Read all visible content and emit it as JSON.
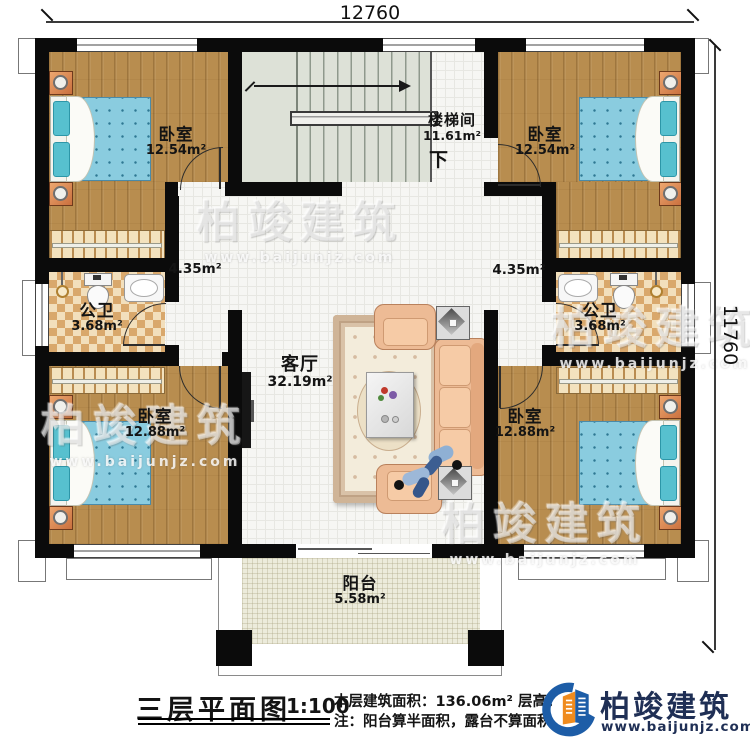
{
  "dimensions": {
    "width_top": "12760",
    "height_right": "11760"
  },
  "watermark": {
    "brand": "柏竣建筑",
    "url": "www.baijunjz.com"
  },
  "rooms": {
    "bedroom_tl": {
      "name": "卧室",
      "area": "12.54m²"
    },
    "bedroom_tr": {
      "name": "卧室",
      "area": "12.54m²"
    },
    "bedroom_bl": {
      "name": "卧室",
      "area": "12.88m²"
    },
    "bedroom_br": {
      "name": "卧室",
      "area": "12.88m²"
    },
    "stairwell": {
      "name": "楼梯间",
      "area": "11.61m²",
      "down": "下"
    },
    "bathroom_left": {
      "name": "公卫",
      "area": "3.68m²"
    },
    "bathroom_right": {
      "name": "公卫",
      "area": "3.68m²"
    },
    "hallway_left": {
      "area": "4.35m²"
    },
    "hallway_right": {
      "area": "4.35m²"
    },
    "living_room": {
      "name": "客厅",
      "area": "32.19m²"
    },
    "balcony": {
      "name": "阳台",
      "area": "5.58m²"
    }
  },
  "footer": {
    "title": "三层平面图",
    "scale": "1:100",
    "info_line1": "本层建筑面积：136.06m²  层高：3",
    "info_line2": "注：阳台算半面积，露台不算面积",
    "brand": "柏竣建筑",
    "brand_url": "www.baijunjz.com"
  }
}
